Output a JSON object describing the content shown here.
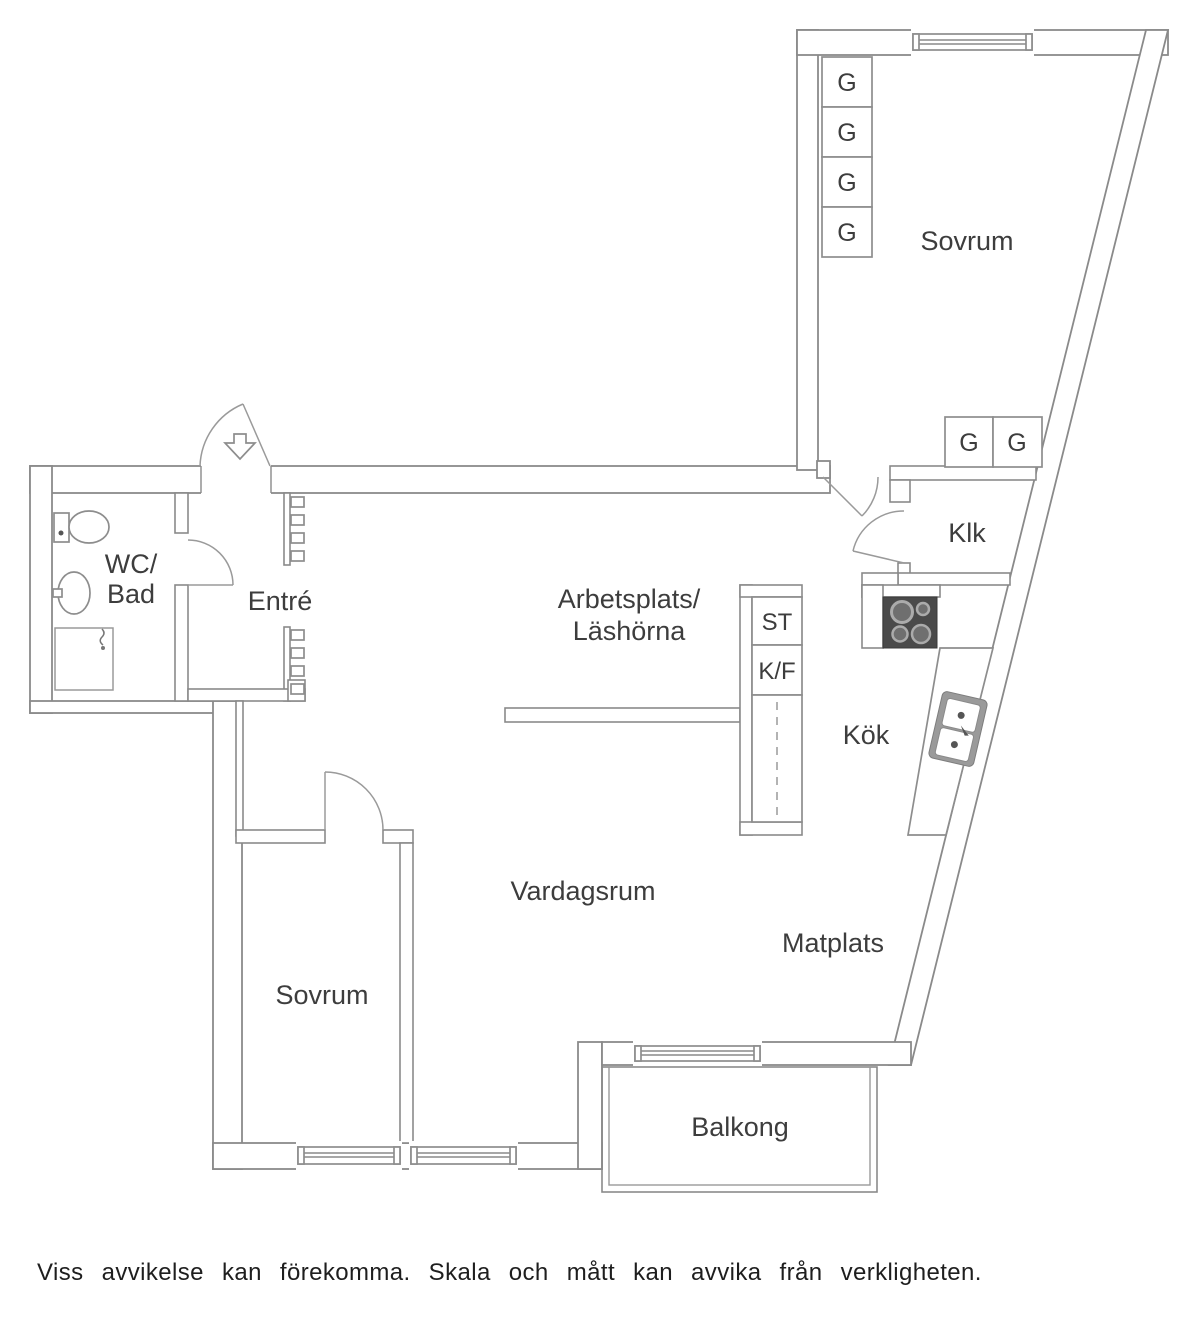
{
  "labels": {
    "sovrum_top": "Sovrum",
    "sovrum_bottom": "Sovrum",
    "wc_line1": "WC/",
    "wc_line2": "Bad",
    "entre": "Entré",
    "arbetsplats_line1": "Arbetsplats/",
    "arbetsplats_line2": "Läshörna",
    "klk": "Klk",
    "kok": "Kök",
    "vardagsrum": "Vardagsrum",
    "matplats": "Matplats",
    "balkong": "Balkong",
    "wardrobe": "G",
    "storage": "ST",
    "fridge_freezer": "K/F",
    "disclaimer": "Viss avvikelse kan förekomma. Skala och mått kan avvika från verkligheten."
  },
  "colors": {
    "wall_line": "#8a8a8a",
    "label_text": "#3d3d3d",
    "stove_body": "#4a4a4a",
    "burner": "#6f6f6f",
    "sink_frame": "#9a9a9a",
    "background": "#ffffff"
  }
}
